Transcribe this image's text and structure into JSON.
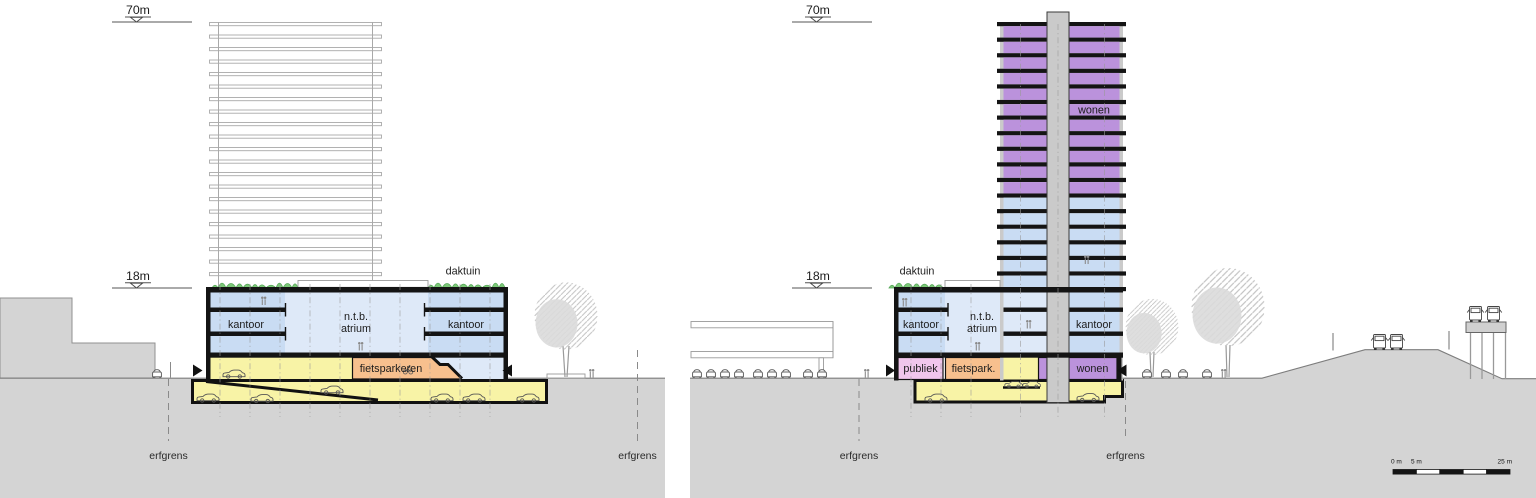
{
  "colors": {
    "kantoor": "#c9dcf3",
    "atrium": "#dee9f8",
    "wonen": "#bb92dc",
    "publiek": "#f0c6ec",
    "fiets": "#f7c08e",
    "parking": "#f8f3a6",
    "green": "#7cc878",
    "ground": "#d4d4d4",
    "core": "#cacaca",
    "ghost": "#a9a9a9",
    "slab": "#141414",
    "tree": "#dadada"
  },
  "left": {
    "datum_top": "70m",
    "datum_mid": "18m",
    "daktuin": "daktuin",
    "kantoor_left": "kantoor",
    "ntb1": "n.t.b.",
    "ntb2": "atrium",
    "kantoor_right": "kantoor",
    "fietsparkeren": "fietsparkeren",
    "erfgrens": "erfgrens",
    "ghost_floor_count": 21
  },
  "right": {
    "datum_top": "70m",
    "datum_mid": "18m",
    "daktuin": "daktuin",
    "kantoor_left": "kantoor",
    "ntb1": "n.t.b.",
    "ntb2": "atrium",
    "kantoor_right": "kantoor",
    "wonen_tower": "wonen",
    "publiek": "publiek",
    "fietspark": "fietspark.",
    "wonen_ground": "wonen",
    "erfgrens": "erfgrens",
    "tower": {
      "wonen_floor_count": 11,
      "kantoor_floor_count": 6
    }
  },
  "scale_bar": {
    "label_0": "0 m",
    "label_5": "5 m",
    "label_25": "25 m",
    "segments": 5
  }
}
